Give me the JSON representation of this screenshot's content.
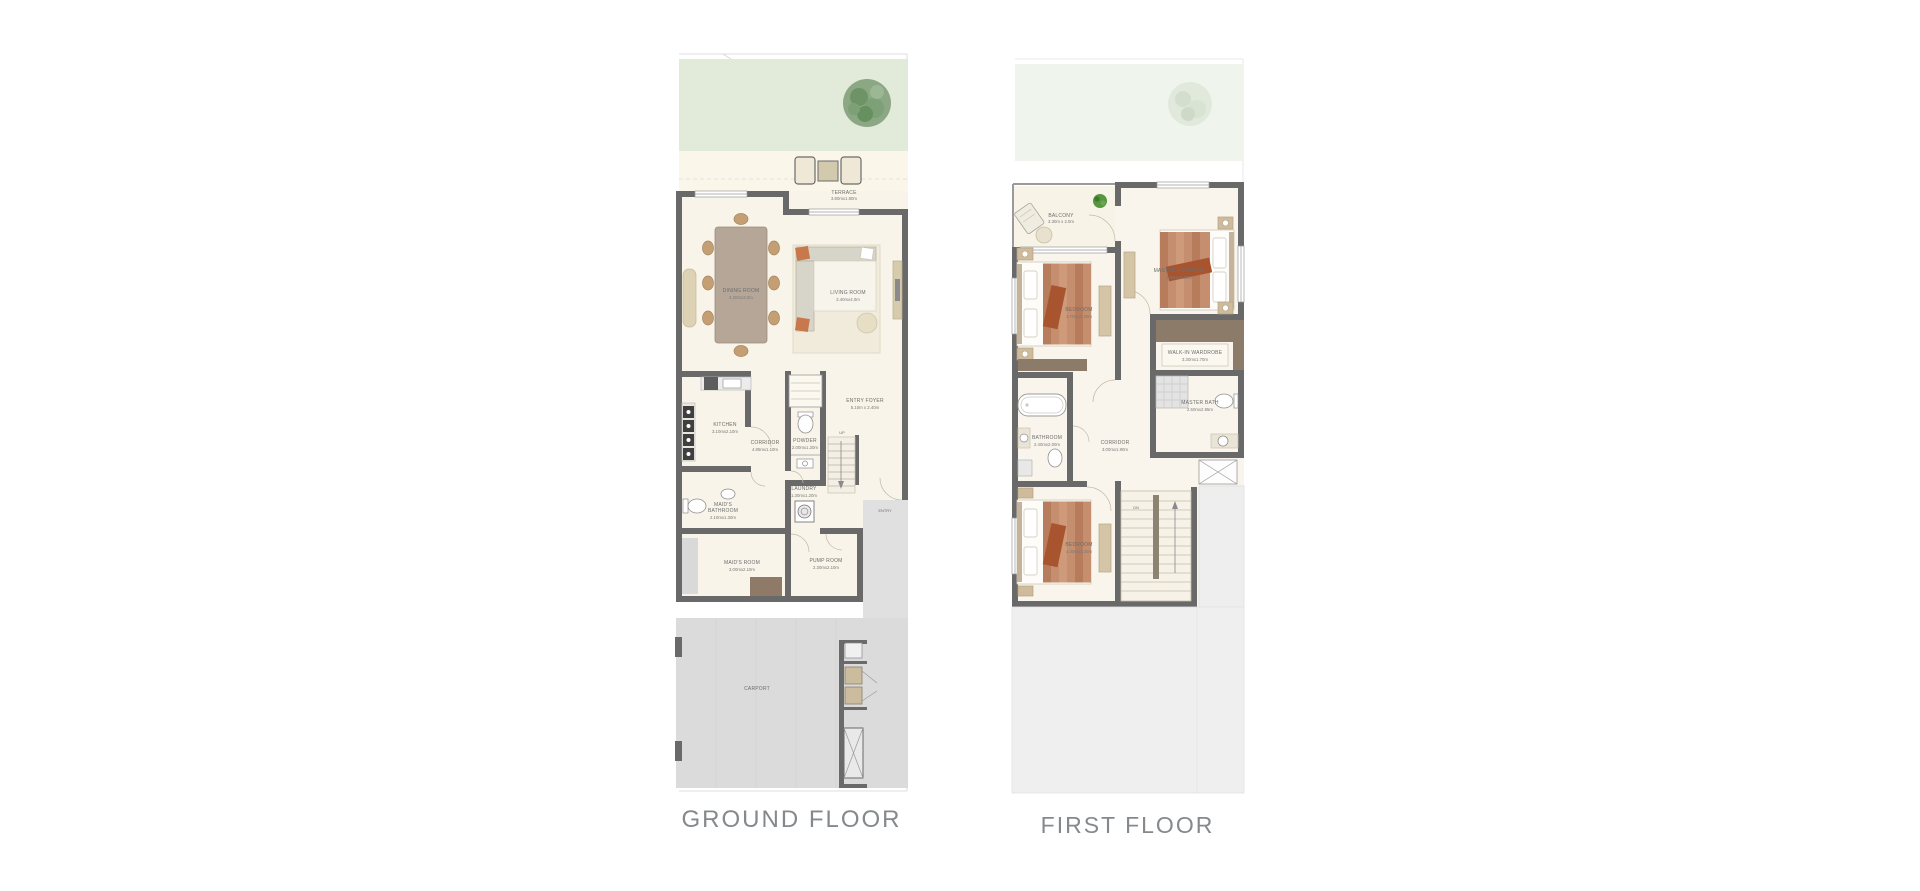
{
  "captions": {
    "ground_floor": "GROUND FLOOR",
    "first_floor": "FIRST FLOOR"
  },
  "colors": {
    "wall": "#696969",
    "floor_cream": "#f8f4e9",
    "garden_green": "#e2ebd9",
    "carport_gray": "#dbdbdb",
    "wardrobe_brown": "#8d7b6a",
    "accent_orange": "#c1744a",
    "caption_text": "#85898c"
  },
  "ground_floor": {
    "stair_label": "UP",
    "entry_label": "ENTRY",
    "carport_label": "CARPORT",
    "rooms": {
      "terrace": {
        "name": "TERRACE",
        "dims": "3.80mx1.80m"
      },
      "dining_room": {
        "name": "DINING ROOM",
        "dims": "4.20mx3.0m"
      },
      "living_room": {
        "name": "LIVING ROOM",
        "dims": "3.40mx4.0m"
      },
      "kitchen": {
        "name": "KITCHEN",
        "dims": "3.10mx2.10m"
      },
      "corridor": {
        "name": "CORRIDOR",
        "dims": "4.85mx1.10m"
      },
      "powder": {
        "name": "POWDER",
        "dims": "2.00mx1.20m"
      },
      "entry_foyer": {
        "name": "ENTRY FOYER",
        "dims": "5.10m x 2.40m"
      },
      "laundry": {
        "name": "LAUNDRY",
        "dims": "1.30mx1.20m"
      },
      "maids_bathroom": {
        "name": "MAID'S",
        "name2": "BATHROOM",
        "dims": "2.10mx1.30m"
      },
      "maids_room": {
        "name": "MAID'S ROOM",
        "dims": "3.00mx2.10m"
      },
      "pump_room": {
        "name": "PUMP ROOM",
        "dims": "2.30mx2.10m"
      }
    }
  },
  "first_floor": {
    "stair_label": "DN",
    "rooms": {
      "balcony": {
        "name": "BALCONY",
        "dims": "3.30m x 2.0m"
      },
      "bedroom_1": {
        "name": "BEDROOM",
        "dims": "3.70mx3.30m"
      },
      "master_bedroom": {
        "name": "MASTER BEDROOM",
        "dims": "3.90mx3.85m"
      },
      "walk_in_wardrobe": {
        "name": "WALK-IN WARDROBE",
        "dims": "3.30mx1.70m"
      },
      "master_bath": {
        "name": "MASTER BATH",
        "dims": "2.50mx2.85m"
      },
      "bathroom": {
        "name": "BATHROOM",
        "dims": "2.40mx2.00m"
      },
      "corridor": {
        "name": "CORRIDOR",
        "dims": "3.00mx1.90m"
      },
      "bedroom_2": {
        "name": "BEDROOM",
        "dims": "4.30mx3.30m"
      }
    }
  }
}
